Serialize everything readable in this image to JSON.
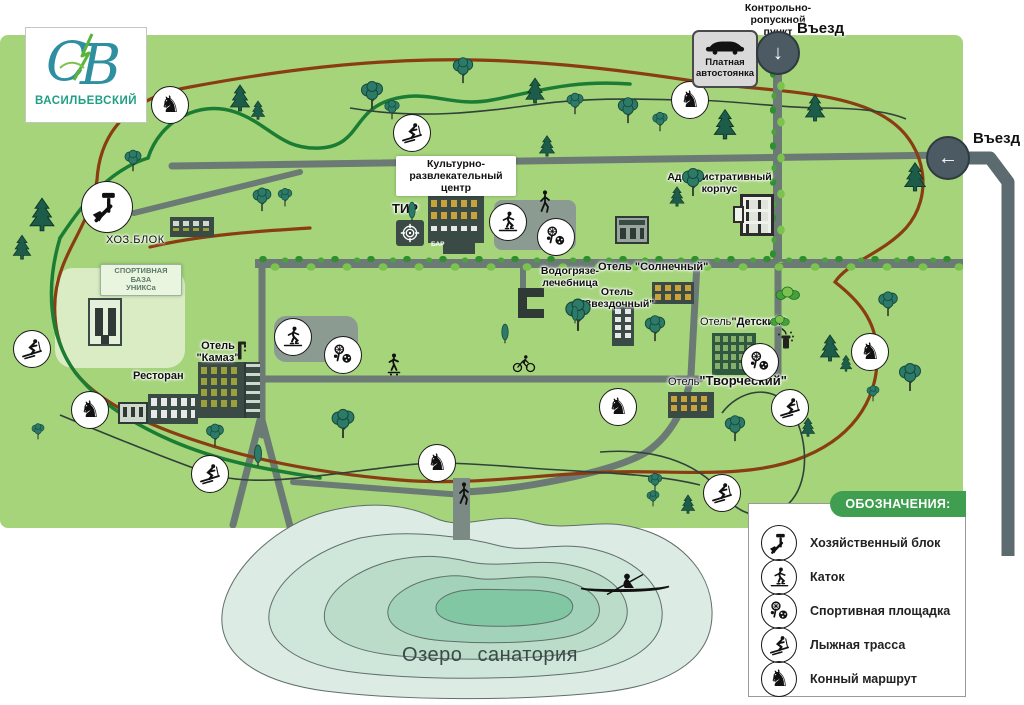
{
  "logo": {
    "brand": "ВАСИЛЬЕВСКИЙ",
    "monogram": "СВ"
  },
  "entrance_top": {
    "checkpoint": "Контрольно-\nропускной\nпункт",
    "label": "Въезд"
  },
  "entrance_right": {
    "label": "Въезд"
  },
  "parking": {
    "label": "Платная\nавтостоянка"
  },
  "facilities": {
    "cultural_center": "Культурно-\nразвлекательный\nцентр",
    "bar": "БАР",
    "shooting_range": "ТИР",
    "admin_building": "Административный\nкорпус",
    "utility_block": "ХОЗ.БЛОК",
    "sports_base": "СПОРТИВНАЯ\nБАЗА\nУНИКСа",
    "mud_baths": "Водогрязе-\nлечебница",
    "hotel_sunny": "Отель \"Солнечный\"",
    "hotel_star": "Отель\n\"Звездочный\"",
    "hotel_kids_prefix": "Отель",
    "hotel_kids_name": "\"Детский\"",
    "hotel_kamaz": "Отель\n\"Камаз\"",
    "hotel_creative_prefix": "Отель",
    "hotel_creative_name": "\"Творческий\"",
    "restaurant": "Ресторан"
  },
  "lake": {
    "label": "Озеро санатория"
  },
  "legend": {
    "title": "ОБОЗНАЧЕНИЯ:",
    "items": [
      {
        "type": "tools",
        "label": "Хозяйственный блок"
      },
      {
        "type": "skater",
        "label": "Каток"
      },
      {
        "type": "sports",
        "label": "Спортивная площадка"
      },
      {
        "type": "skier",
        "label": "Лыжная трасса"
      },
      {
        "type": "horse",
        "label": "Конный маршрут"
      }
    ]
  },
  "map_markers": [
    {
      "type": "horse",
      "x": 170,
      "y": 105
    },
    {
      "type": "horse",
      "x": 690,
      "y": 100
    },
    {
      "type": "horse",
      "x": 90,
      "y": 410
    },
    {
      "type": "horse",
      "x": 437,
      "y": 463
    },
    {
      "type": "horse",
      "x": 618,
      "y": 407
    },
    {
      "type": "horse",
      "x": 870,
      "y": 352
    },
    {
      "type": "skier",
      "x": 412,
      "y": 133
    },
    {
      "type": "skier",
      "x": 32,
      "y": 349
    },
    {
      "type": "skier",
      "x": 210,
      "y": 474
    },
    {
      "type": "skier",
      "x": 790,
      "y": 408
    },
    {
      "type": "skier",
      "x": 722,
      "y": 493
    },
    {
      "type": "skater",
      "x": 508,
      "y": 222
    },
    {
      "type": "skater",
      "x": 293,
      "y": 337
    },
    {
      "type": "sports",
      "x": 556,
      "y": 237
    },
    {
      "type": "sports",
      "x": 343,
      "y": 355
    },
    {
      "type": "sports",
      "x": 760,
      "y": 362
    },
    {
      "type": "tools",
      "x": 107,
      "y": 207,
      "size": "big"
    }
  ],
  "icons": {
    "horse_glyph": "♞",
    "down_arrow": "↓",
    "left_arrow": "←"
  },
  "colors": {
    "map_green": "#a5d47b",
    "road_gray": "#6b7a74",
    "trail_green": "#1b7c33",
    "trail_brown": "#8a3c12",
    "legend_green": "#3f9e4f",
    "brand_teal": "#1f9f85",
    "lake_outer": "#dcebe4",
    "lake_inner": "#82c7a4"
  }
}
